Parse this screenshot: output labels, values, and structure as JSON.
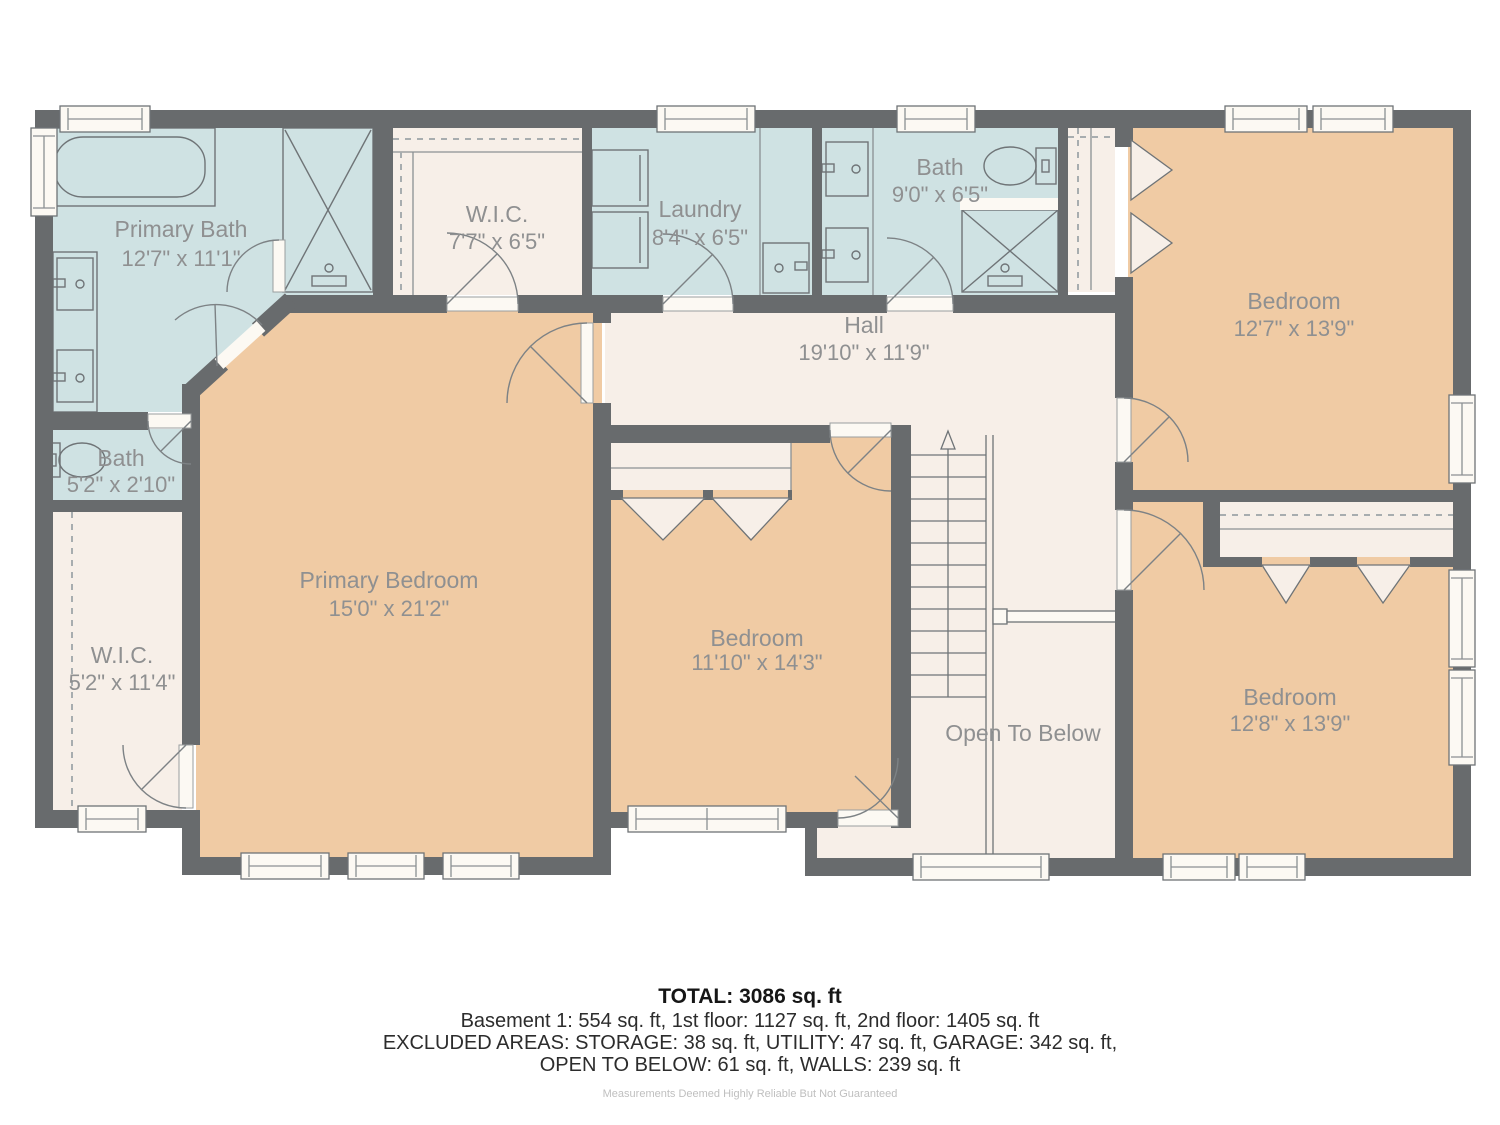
{
  "colors": {
    "wall": "#686b6d",
    "bath_floor": "#cfe2e3",
    "bedroom_floor": "#f0cba4",
    "hall_floor": "#f7efe8",
    "window_door": "#fcf9f3",
    "label_text": "#8f9091",
    "footer_text": "#2c2c2c"
  },
  "rooms": [
    {
      "id": "primary-bath",
      "name": "Primary Bath",
      "dims": "12'7\" x 11'1\""
    },
    {
      "id": "wic-upper",
      "name": "W.I.C.",
      "dims": "7'7\" x 6'5\""
    },
    {
      "id": "laundry",
      "name": "Laundry",
      "dims": "8'4\" x 6'5\""
    },
    {
      "id": "bath",
      "name": "Bath",
      "dims": "9'0\" x 6'5\""
    },
    {
      "id": "bedroom-top-right",
      "name": "Bedroom",
      "dims": "12'7\" x 13'9\""
    },
    {
      "id": "hall",
      "name": "Hall",
      "dims": "19'10\" x 11'9\""
    },
    {
      "id": "bath-small",
      "name": "Bath",
      "dims": "5'2\" x 2'10\""
    },
    {
      "id": "primary-bedroom",
      "name": "Primary Bedroom",
      "dims": "15'0\" x 21'2\""
    },
    {
      "id": "wic-lower",
      "name": "W.I.C.",
      "dims": "5'2\" x 11'4\""
    },
    {
      "id": "bedroom-middle",
      "name": "Bedroom",
      "dims": "11'10\" x 14'3\""
    },
    {
      "id": "open-to-below",
      "name": "Open To Below",
      "dims": ""
    },
    {
      "id": "bedroom-bottom-right",
      "name": "Bedroom",
      "dims": "12'8\" x 13'9\""
    }
  ],
  "footer": {
    "total": "TOTAL: 3086 sq. ft",
    "line1": "Basement 1: 554 sq. ft, 1st floor: 1127 sq. ft, 2nd floor: 1405 sq. ft",
    "line2": "EXCLUDED AREAS: STORAGE: 38 sq. ft, UTILITY: 47 sq. ft, GARAGE: 342 sq. ft,",
    "line3": "OPEN TO BELOW: 61 sq. ft, WALLS: 239 sq. ft",
    "disclaimer": "Measurements Deemed Highly Reliable But Not Guaranteed"
  }
}
